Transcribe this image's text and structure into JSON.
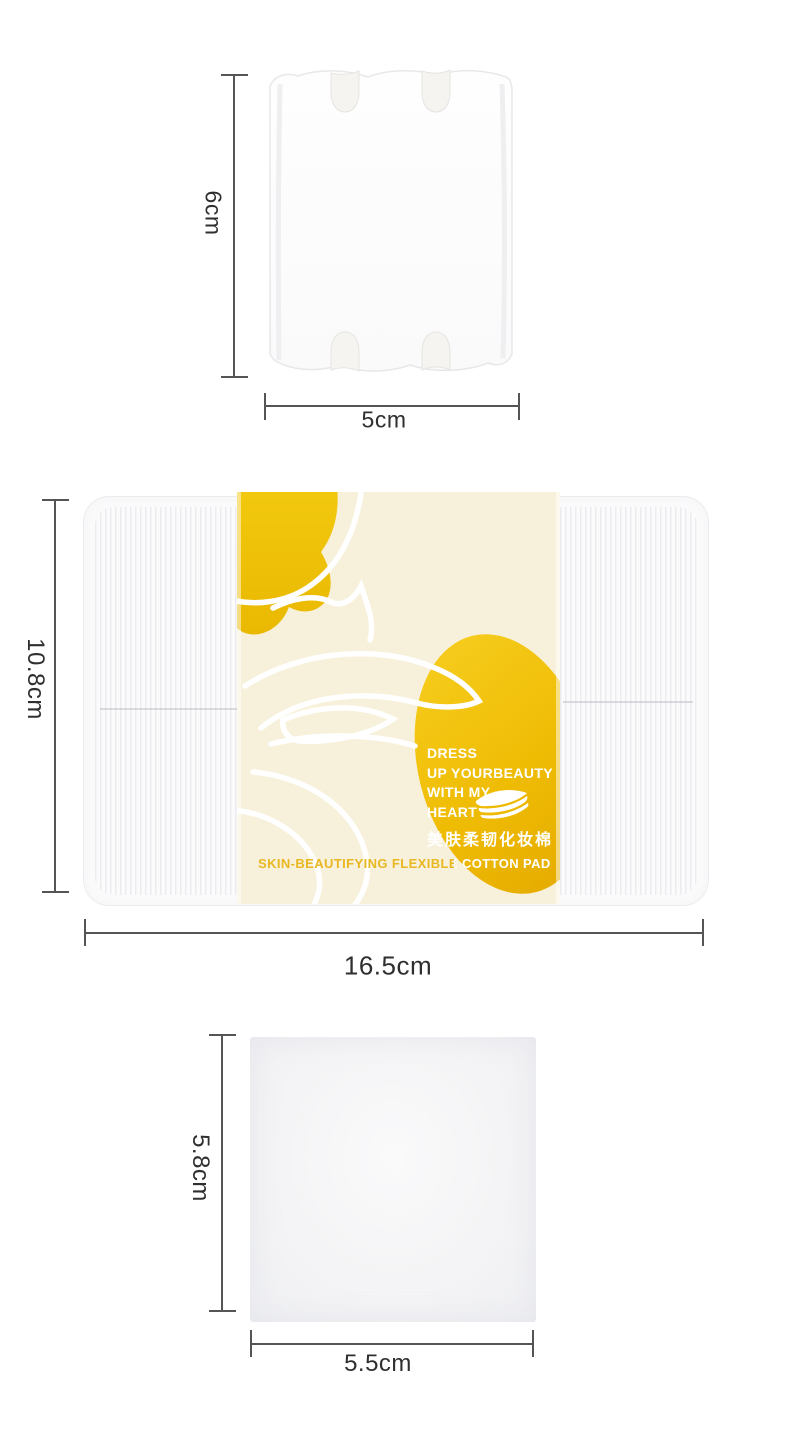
{
  "colors": {
    "accent_yellow": "#F0C30A",
    "sleeve_cream": "#F7F1DB",
    "gold_text": "#E9B722",
    "dimension_line": "#555555"
  },
  "icons": {
    "pad_stack": "cotton-pad-stack"
  },
  "top_pad": {
    "height_label": "6cm",
    "width_label": "5cm"
  },
  "package": {
    "height_label": "10.8cm",
    "width_label": "16.5cm",
    "sleeve": {
      "tagline": [
        "DRESS",
        "UP YOURBEAUTY",
        "WITH MY",
        "HEART"
      ],
      "product_name_cn": "美肤柔韧化妆棉",
      "product_name_en": "SKIN-BEAUTIFYING FLEXIBLE COTTON PAD"
    }
  },
  "bottom_pad": {
    "height_label": "5.8cm",
    "width_label": "5.5cm"
  }
}
